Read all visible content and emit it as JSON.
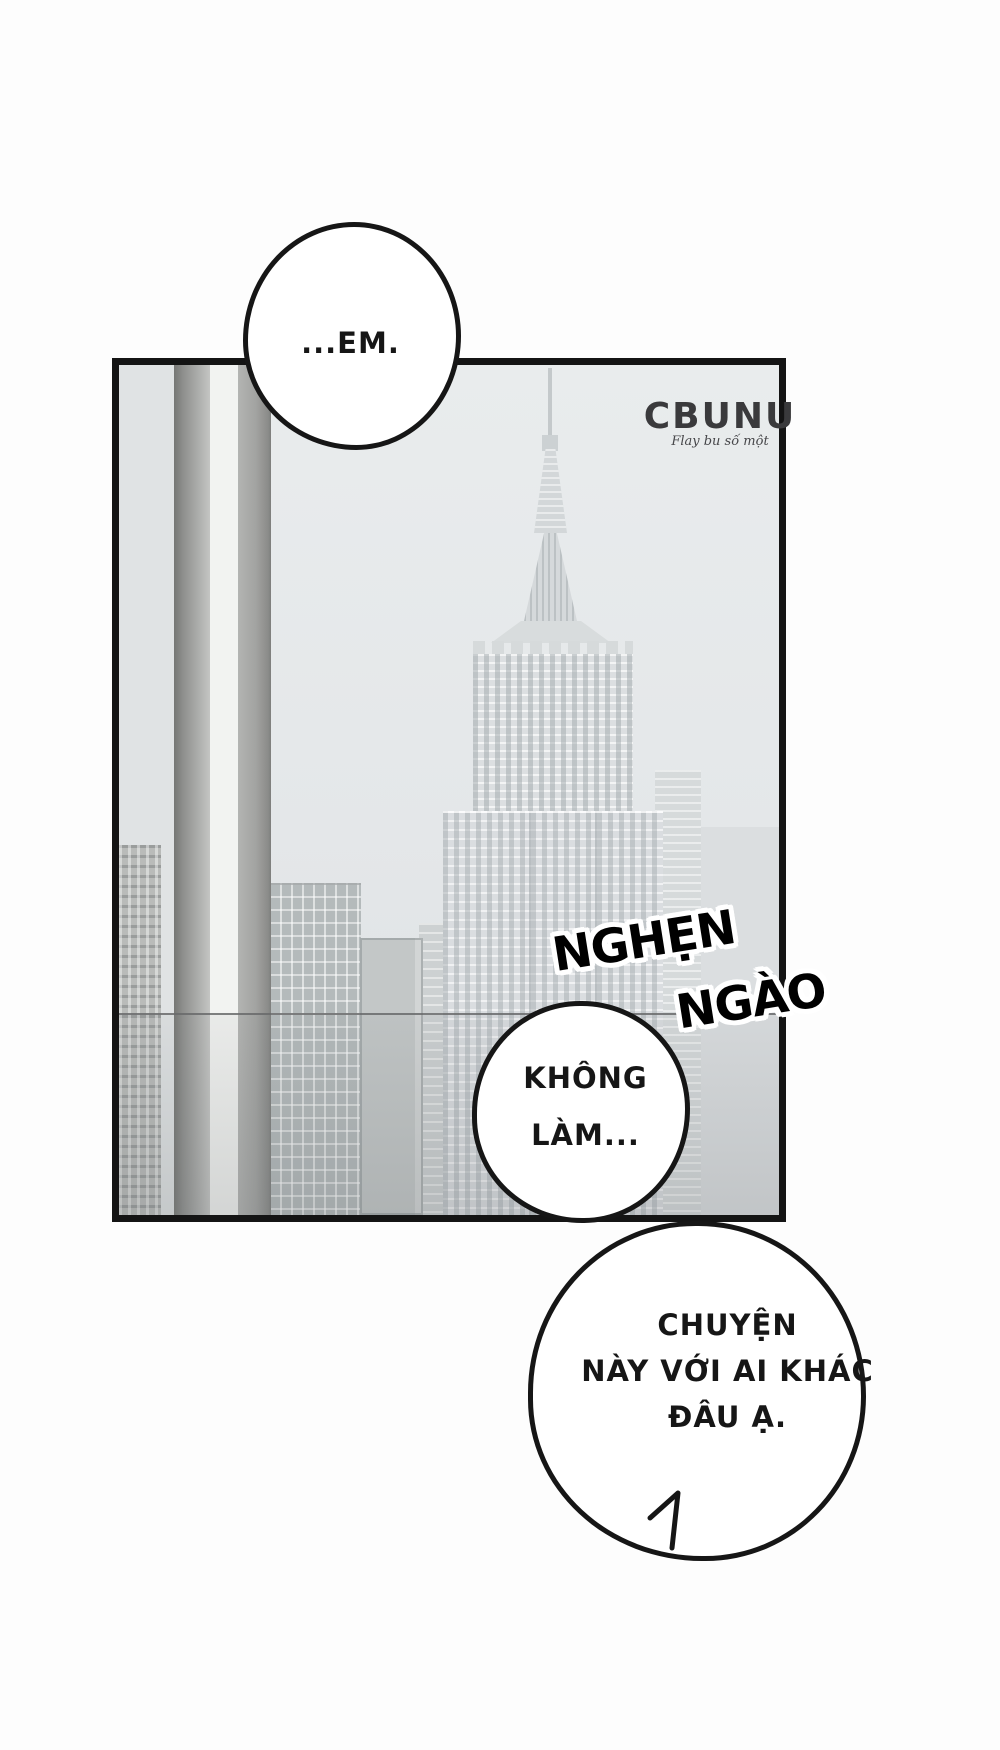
{
  "watermark": {
    "brand": "CBUNU",
    "tagline": "Flay bu số một",
    "ink": "#3a3a3c"
  },
  "sfx": {
    "line1": "NGHẸN",
    "line2": "NGÀO",
    "fill": "#000000",
    "outline": "#ffffff"
  },
  "bubbles": {
    "top": {
      "line1": "...EM."
    },
    "middle": {
      "line1": "KHÔNG",
      "line2": "LÀM..."
    },
    "bottom": {
      "line1": "CHUYỆN",
      "line2": "NÀY VỚI AI KHÁC",
      "line3": "ĐÂU Ạ."
    }
  },
  "colors": {
    "page_background": "#fdfdfd",
    "panel_border": "#141414",
    "panel_sky": "#e5e8e9",
    "ink": "#161616"
  }
}
